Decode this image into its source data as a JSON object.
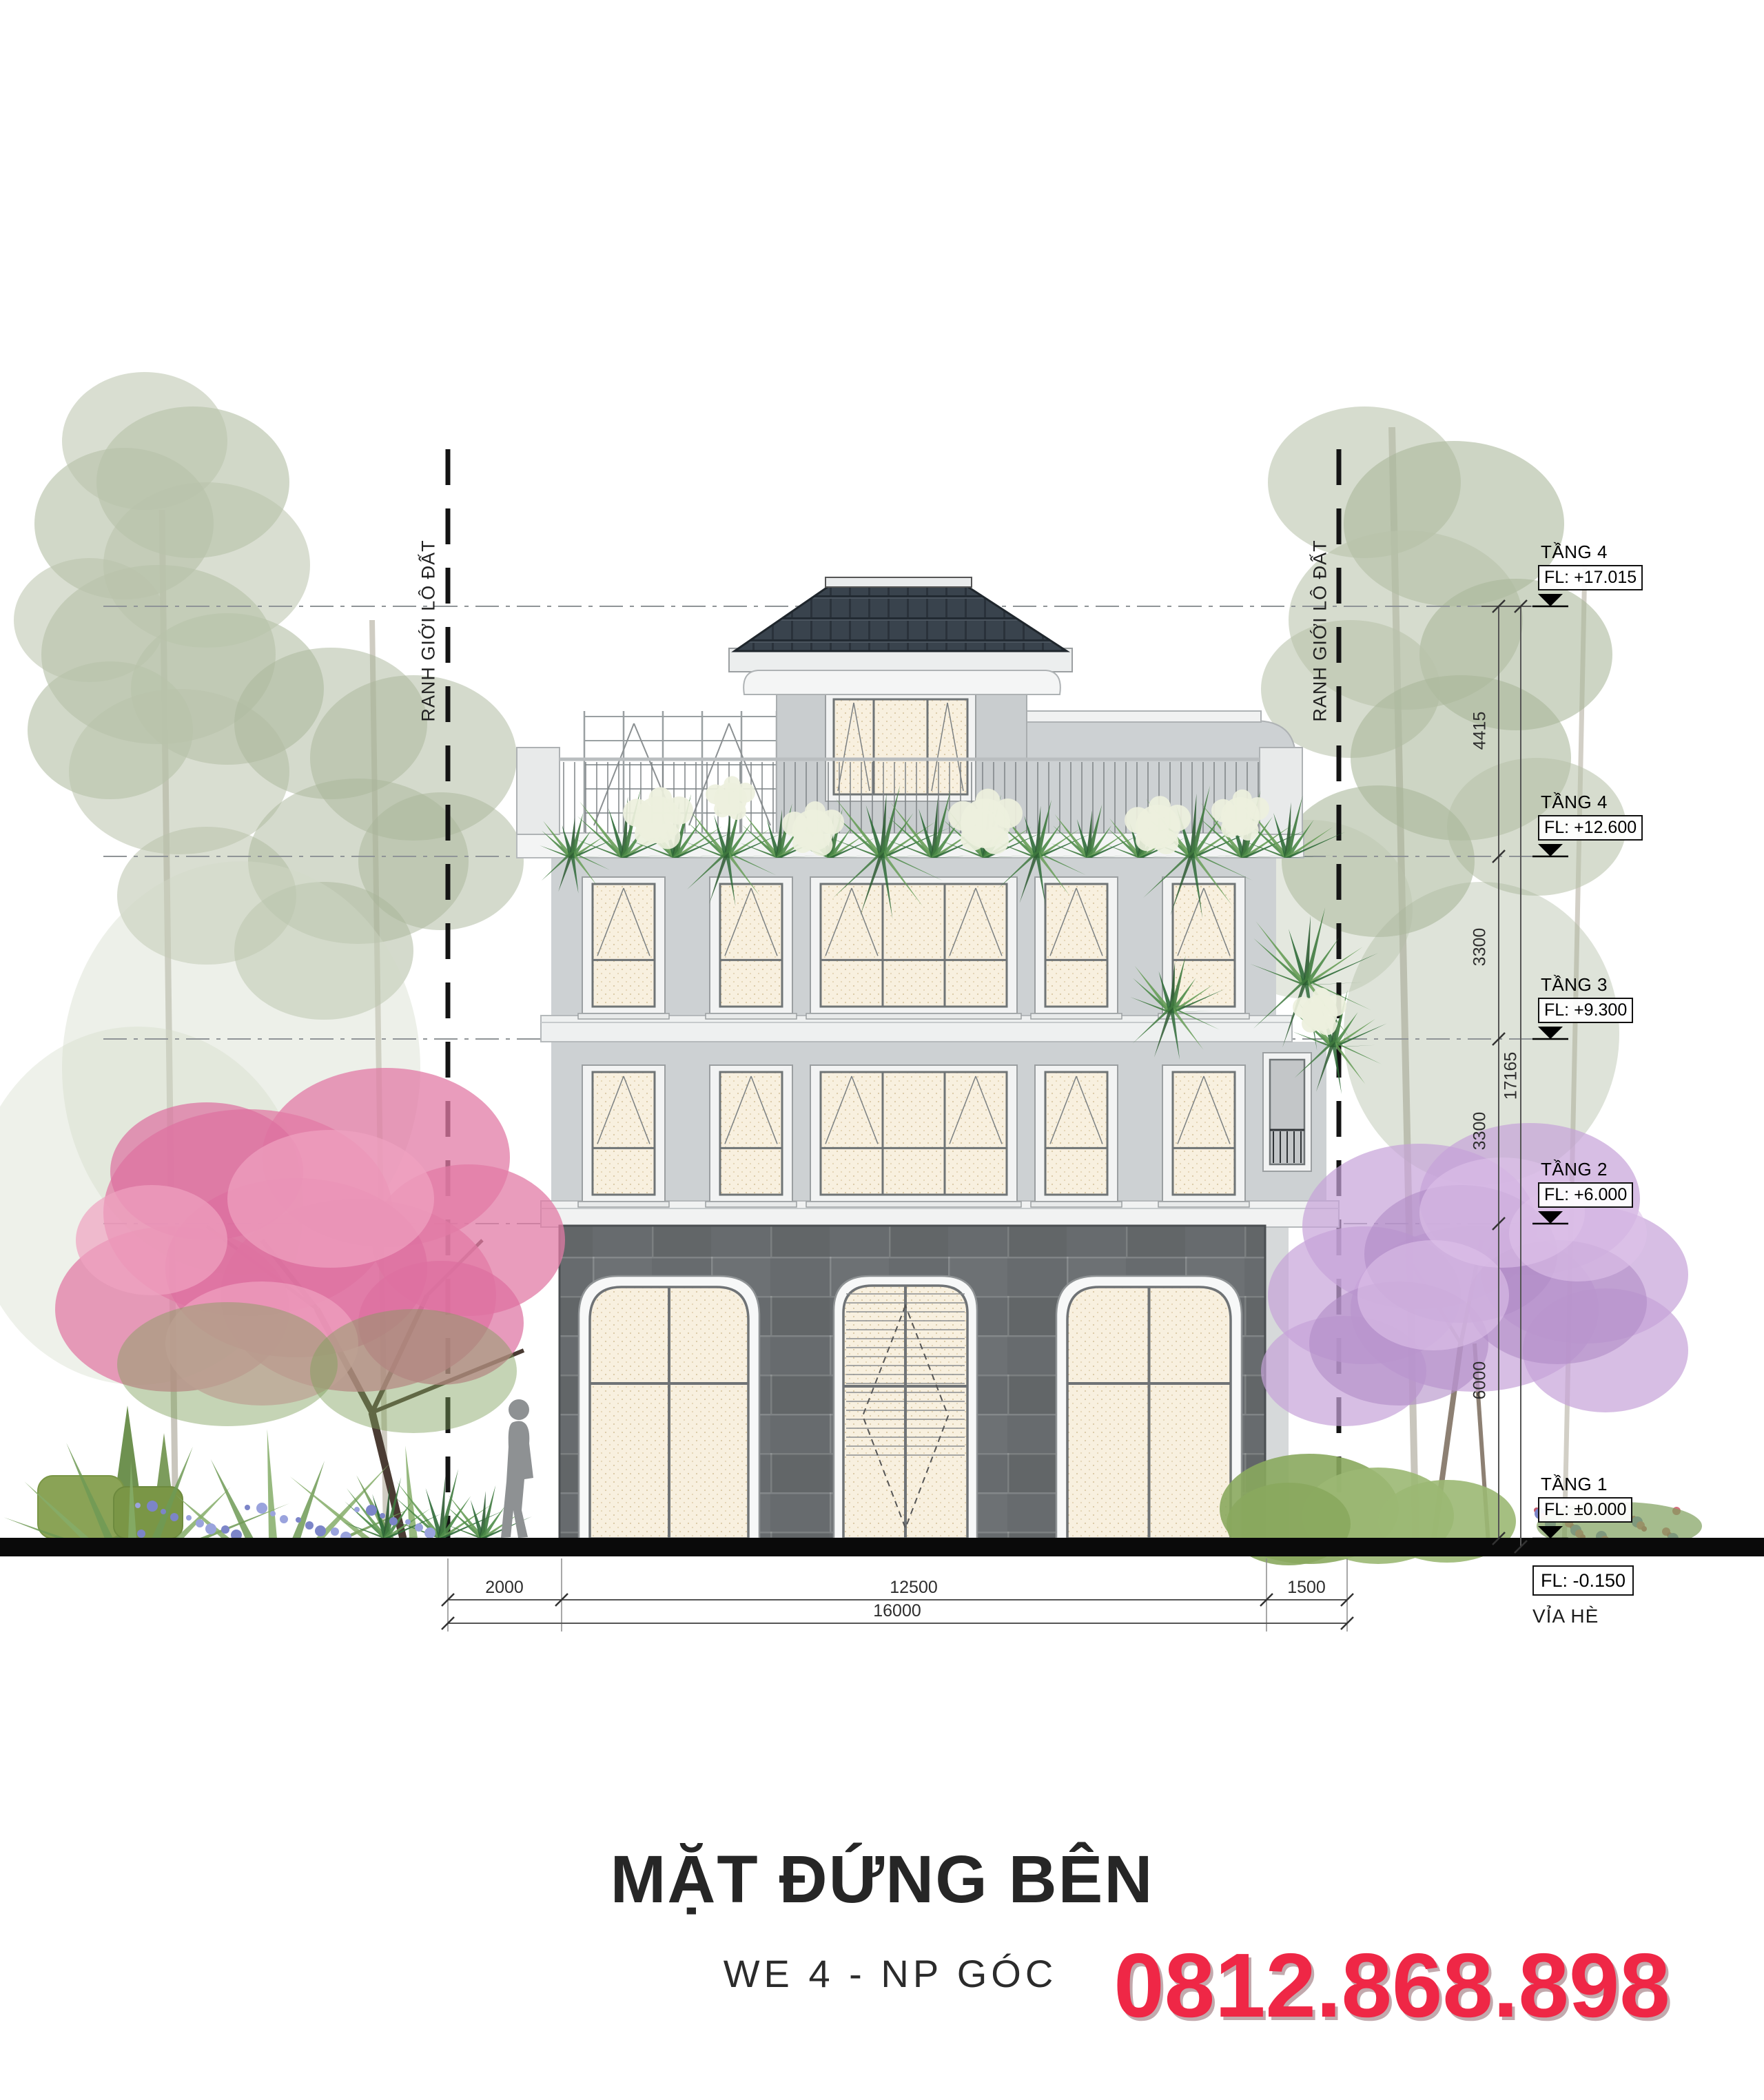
{
  "drawing": {
    "title": "MẶT ĐỨNG BÊN",
    "subtitle": "WE 4 - NP GÓC",
    "phone": "0812.868.898"
  },
  "levels": [
    {
      "name": "TẦNG 4",
      "fl": "FL: +17.015"
    },
    {
      "name": "TẦNG 4",
      "fl": "FL: +12.600"
    },
    {
      "name": "TẦNG 3",
      "fl": "FL: +9.300"
    },
    {
      "name": "TẦNG 2",
      "fl": "FL: +6.000"
    },
    {
      "name": "TẦNG 1",
      "fl": "FL: ±0.000"
    }
  ],
  "ground": {
    "fl": "FL:  -0.150",
    "label": "VỈA HÈ"
  },
  "boundary_label": "RANH GIỚI LÔ ĐẤT",
  "dimensions": {
    "vertical": [
      "4415",
      "3300",
      "3300",
      "6000"
    ],
    "vertical_total": "17165",
    "horizontal": [
      "2000",
      "12500",
      "1500"
    ],
    "horizontal_total": "16000"
  },
  "colors": {
    "phone_red": "#ef2746",
    "roof_dark": "#39434d",
    "wall_light": "#cdd1d3",
    "wall_stone": "#676b6e",
    "pane_cream": "#f8f0df",
    "band_white": "#f2f3f3",
    "tree_pale_green": "#b9c3ab",
    "tree_pink": "#dd6f9f",
    "tree_purple": "#c6a3d8",
    "ground_band": "#0a0a0a"
  }
}
